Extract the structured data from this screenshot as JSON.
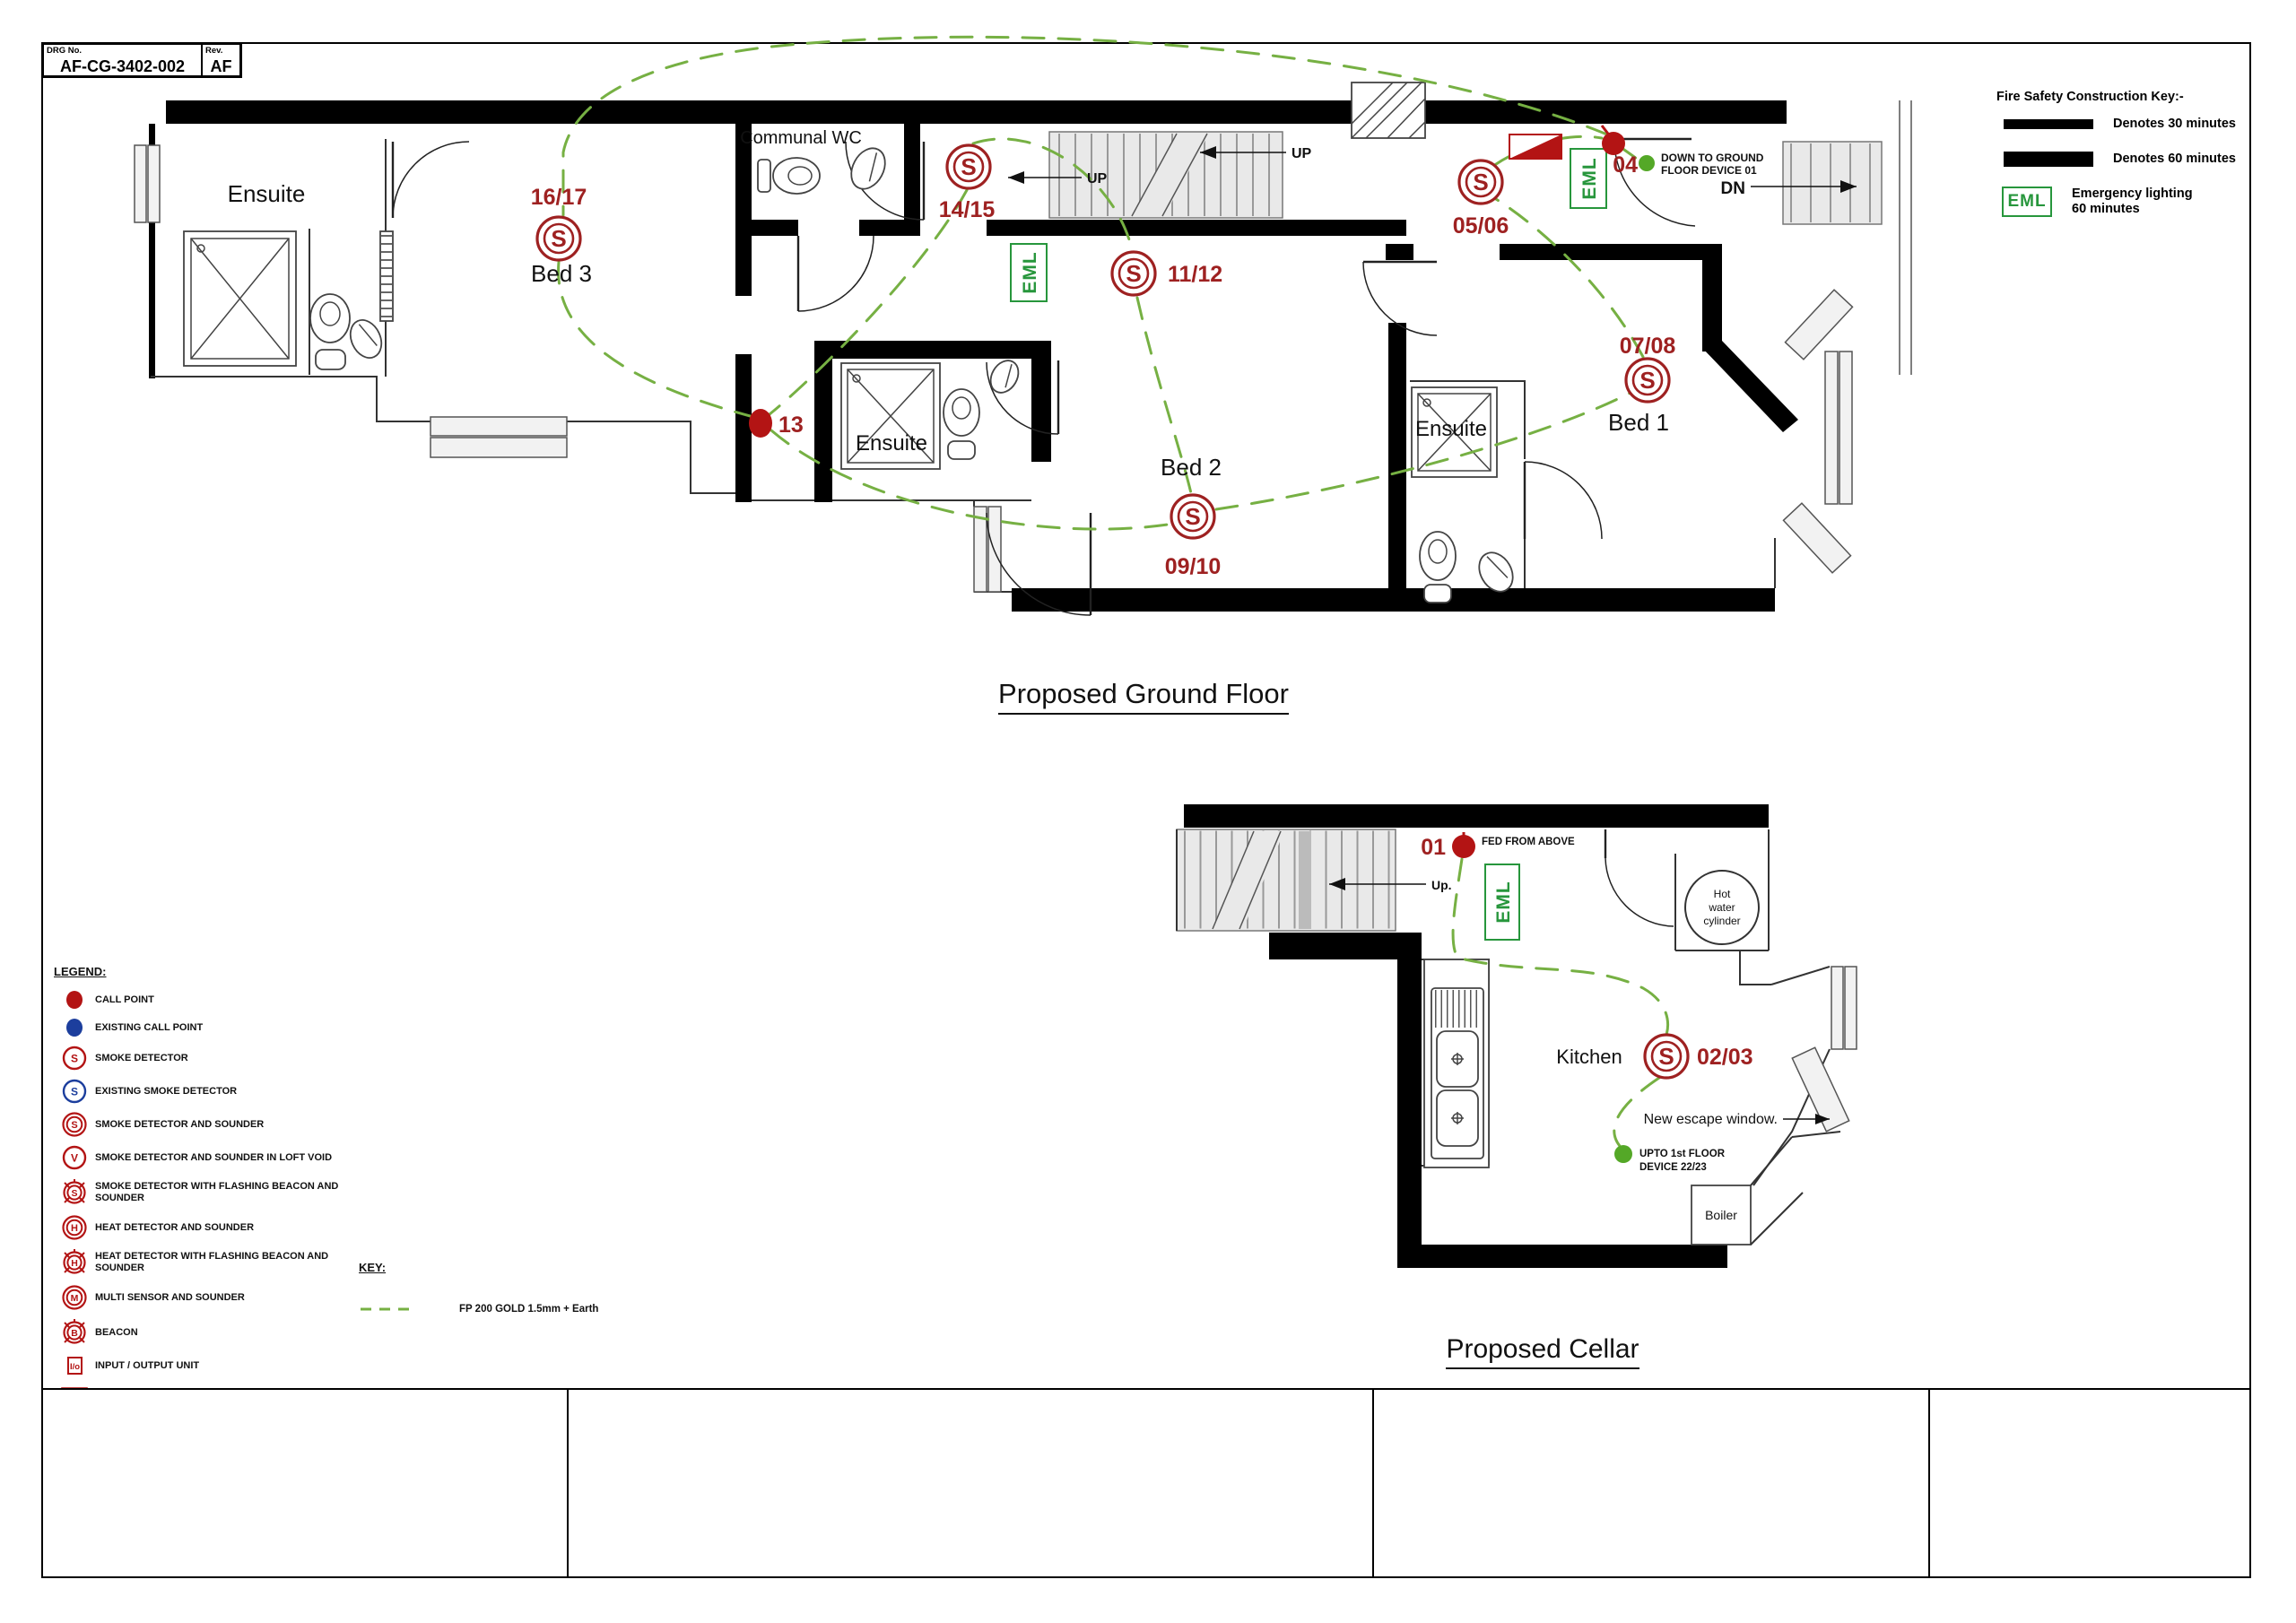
{
  "sheet": {
    "drg_label": "DRG No.",
    "drg_no": "AF-CG-3402-002",
    "rev_label": "Rev.",
    "rev_value": "AF"
  },
  "fire_key": {
    "title": "Fire Safety Construction Key:-",
    "minutes30": "Denotes 30 minutes",
    "minutes60": "Denotes 60 minutes",
    "eml_box": "EML",
    "eml_line1": "Emergency lighting",
    "eml_line2": "60 minutes"
  },
  "ground": {
    "title": "Proposed Ground Floor",
    "rooms": {
      "ensuite_tl": "Ensuite",
      "communal_wc": "Communal WC",
      "bed3": "Bed 3",
      "ensuite_mid": "Ensuite",
      "bed2": "Bed 2",
      "ensuite_right": "Ensuite",
      "bed1": "Bed 1"
    },
    "devices": {
      "d16_17": "16/17",
      "d14_15": "14/15",
      "d11_12": "11/12",
      "d05_06": "05/06",
      "d07_08": "07/08",
      "d09_10": "09/10",
      "c13": "13",
      "c04": "04"
    },
    "notes": {
      "up1": "UP",
      "up2": "UP",
      "dn": "DN",
      "down_line1": "DOWN TO GROUND",
      "down_line2": "FLOOR DEVICE 01"
    },
    "eml": "EML"
  },
  "cellar": {
    "title": "Proposed Cellar",
    "rooms": {
      "kitchen": "Kitchen",
      "boiler": "Boiler"
    },
    "devices": {
      "c01": "01",
      "d02_03": "02/03"
    },
    "notes": {
      "up": "Up.",
      "fed_from_above": "FED FROM ABOVE",
      "hot1": "Hot",
      "hot2": "water",
      "hot3": "cylinder",
      "escape": "New escape window.",
      "upto_line1": "UPTO 1st FLOOR",
      "upto_line2": "DEVICE 22/23"
    },
    "eml": "EML"
  },
  "legend": {
    "heading": "LEGEND:",
    "items": [
      {
        "icon": "call-point",
        "label": "CALL POINT"
      },
      {
        "icon": "existing-call-point",
        "label": "EXISTING CALL POINT"
      },
      {
        "icon": "smoke-detector",
        "label": "SMOKE DETECTOR"
      },
      {
        "icon": "existing-smoke-detector",
        "label": "EXISTING SMOKE DETECTOR"
      },
      {
        "icon": "smoke-detector-sounder",
        "label": "SMOKE DETECTOR AND SOUNDER"
      },
      {
        "icon": "smoke-detector-loft-void",
        "label": "SMOKE DETECTOR AND SOUNDER IN LOFT VOID"
      },
      {
        "icon": "smoke-detector-flashing",
        "label": "SMOKE DETECTOR WITH FLASHING BEACON AND SOUNDER"
      },
      {
        "icon": "heat-detector-sounder",
        "label": "HEAT DETECTOR AND SOUNDER"
      },
      {
        "icon": "heat-detector-flashing",
        "label": "HEAT DETECTOR WITH FLASHING BEACON AND SOUNDER"
      },
      {
        "icon": "multi-sensor",
        "label": "MULTI SENSOR AND SOUNDER"
      },
      {
        "icon": "beacon",
        "label": "BEACON"
      },
      {
        "icon": "io-unit",
        "label": "INPUT / OUTPUT UNIT"
      },
      {
        "icon": "fire-alarm-panel",
        "label": "FIRE ALARM CONTROL PANEL"
      },
      {
        "icon": "sound-beacon",
        "label": "OPEN AREA WALL MOUNTED SOUND/BEACON"
      }
    ]
  },
  "cable_key": {
    "heading": "KEY:",
    "label": "FP 200 GOLD 1.5mm + Earth"
  },
  "symbols": {
    "smoke": "S",
    "void": "V",
    "heat": "H",
    "multi": "M",
    "beacon": "B",
    "io": "I/o"
  },
  "colors": {
    "device-red": "#9e2121",
    "call-red": "#b31414",
    "existing-blue": "#1c3e9d",
    "cable-green": "#76b043",
    "eml-green": "#27963c",
    "dot-green": "#54a827"
  }
}
